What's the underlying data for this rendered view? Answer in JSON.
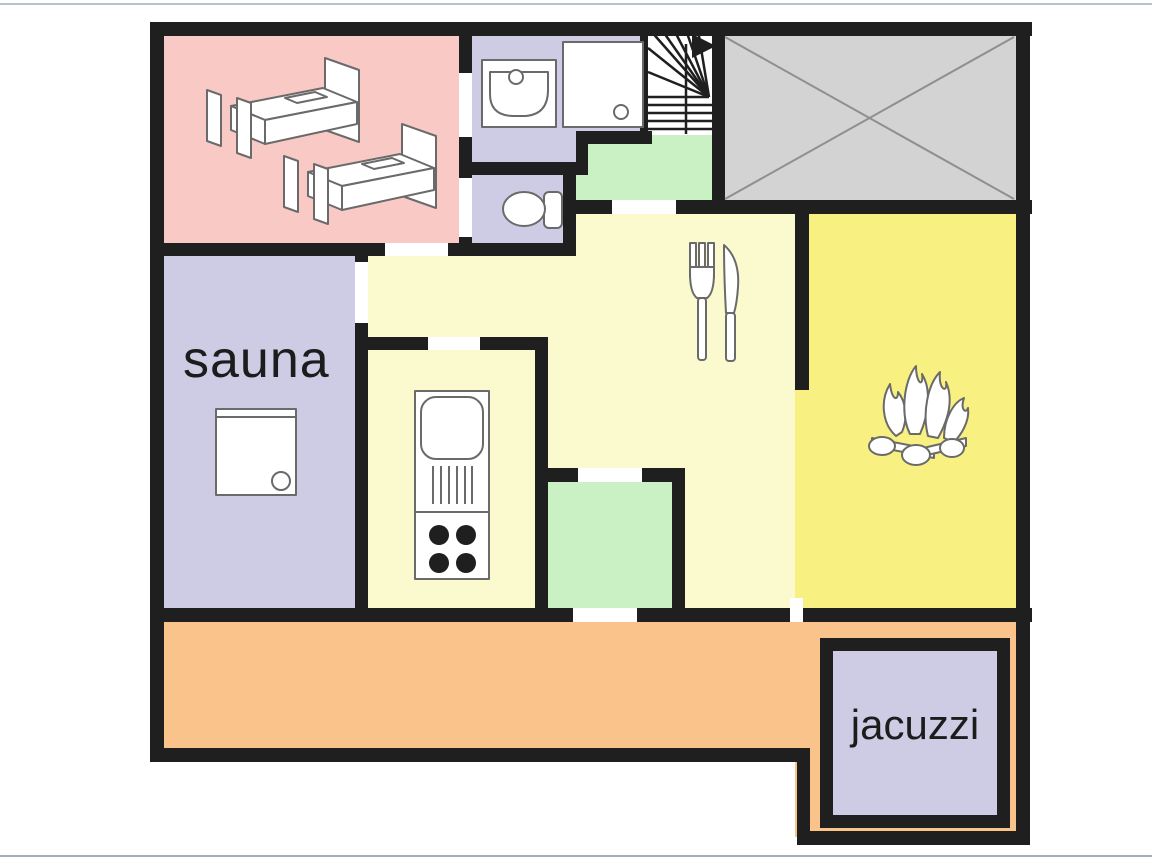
{
  "plan": {
    "title": "chalet floor plan",
    "colors": {
      "wall": "#1f1f1f",
      "pink": "#f9c9c5",
      "lavender": "#cecbe5",
      "pale_yellow": "#fbfacf",
      "bright_yellow": "#f8f182",
      "green": "#c9f1c4",
      "orange": "#f9c38b",
      "gray": "#d3d3d3",
      "white": "#ffffff"
    },
    "labels": {
      "sauna": "sauna",
      "jacuzzi": "jacuzzi"
    },
    "rooms": [
      {
        "id": "bedroom",
        "color_key": "pink",
        "fixtures": [
          "bed-icon",
          "bed-icon"
        ]
      },
      {
        "id": "bathroom",
        "color_key": "lavender",
        "fixtures": [
          "sink-icon",
          "shower-icon"
        ]
      },
      {
        "id": "wc",
        "color_key": "lavender",
        "fixtures": [
          "toilet-icon"
        ]
      },
      {
        "id": "staircase",
        "color_key": "white",
        "fixtures": [
          "stairs-icon",
          "up-arrow-icon"
        ]
      },
      {
        "id": "void",
        "color_key": "gray",
        "fixtures": [
          "crossed-out-icon"
        ]
      },
      {
        "id": "landing",
        "color_key": "green",
        "fixtures": []
      },
      {
        "id": "dining",
        "color_key": "pale_yellow",
        "fixtures": [
          "cutlery-icon"
        ]
      },
      {
        "id": "kitchen",
        "color_key": "pale_yellow",
        "fixtures": [
          "kitchenette-icon"
        ]
      },
      {
        "id": "living",
        "color_key": "bright_yellow",
        "fixtures": [
          "fireplace-icon"
        ]
      },
      {
        "id": "sauna",
        "color_key": "lavender",
        "label": "sauna",
        "fixtures": [
          "sauna-stove-icon"
        ]
      },
      {
        "id": "entry",
        "color_key": "green",
        "fixtures": []
      },
      {
        "id": "terrace",
        "color_key": "orange",
        "fixtures": []
      },
      {
        "id": "jacuzzi",
        "color_key": "lavender",
        "label": "jacuzzi",
        "fixtures": []
      }
    ]
  }
}
